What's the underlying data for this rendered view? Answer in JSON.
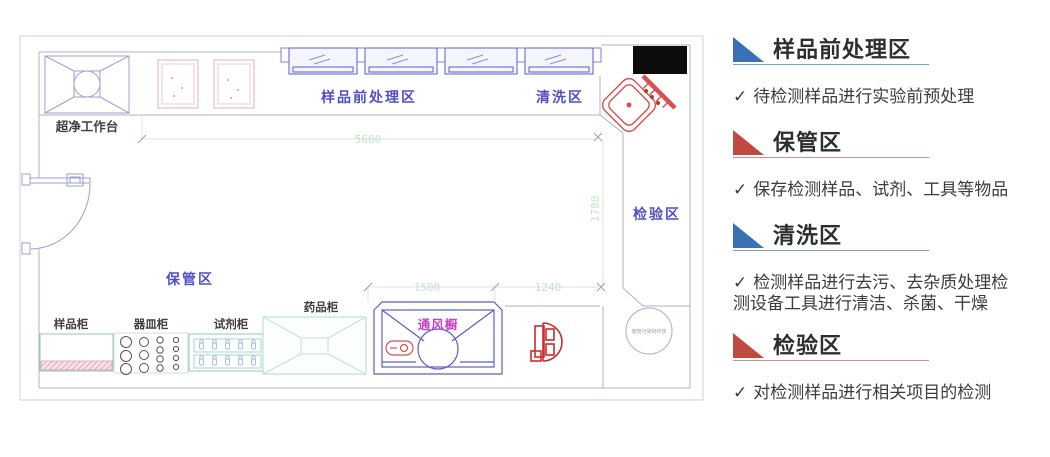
{
  "legend": {
    "check": "✓",
    "sections": [
      {
        "title": "样品前处理区",
        "desc": "待检测样品进行实验前预处理",
        "accent": "#3a70b4",
        "underline": "#7d9fd0"
      },
      {
        "title": "保管区",
        "desc": "保存检测样品、试剂、工具等物品",
        "accent": "#c04a42",
        "underline": "#d29089"
      },
      {
        "title": "清洗区",
        "desc": "检测样品进行去污、去杂质处理检测设备工具进行清洁、杀菌、干燥",
        "accent": "#3a70b4",
        "underline": "#7d9fd0"
      },
      {
        "title": "检验区",
        "desc": "对检测样品进行相关项目的检测",
        "accent": "#c04a42",
        "underline": "#d29089"
      }
    ]
  },
  "plan": {
    "zones": {
      "pretreatment": "样品前处理区",
      "cleaning": "清洗区",
      "inspection": "检验区",
      "storage": "保管区"
    },
    "equipment": {
      "clean_bench": "超净工作台",
      "sample_cabinet": "样品柜",
      "vessel_cabinet": "器皿柜",
      "reagent_cabinet": "试剂柜",
      "medicine_cabinet": "药品柜",
      "fume_hood": "通风橱",
      "waste_circle_micro_text": "废物污染物存放"
    },
    "dimensions": {
      "top_width": "5600",
      "right_height": "1780",
      "fume_hood_width": "1500",
      "corridor_width": "1240"
    },
    "colors": {
      "wall_line": "#aeb2ce",
      "window_blue": "#5b5ec9",
      "zone_label": "#524ec6",
      "equipment_label": "#3f3f3f",
      "fume_hood_label": "#c93ec9",
      "dimension_text": "#c5e5c5",
      "sink_pink": "#e2aec6",
      "red_fixture": "#d64545",
      "cabinet_green": "#8ecfae",
      "table_teal": "#aadbd3",
      "legend_blue": "#3a70b4",
      "legend_red": "#c04a42"
    }
  }
}
